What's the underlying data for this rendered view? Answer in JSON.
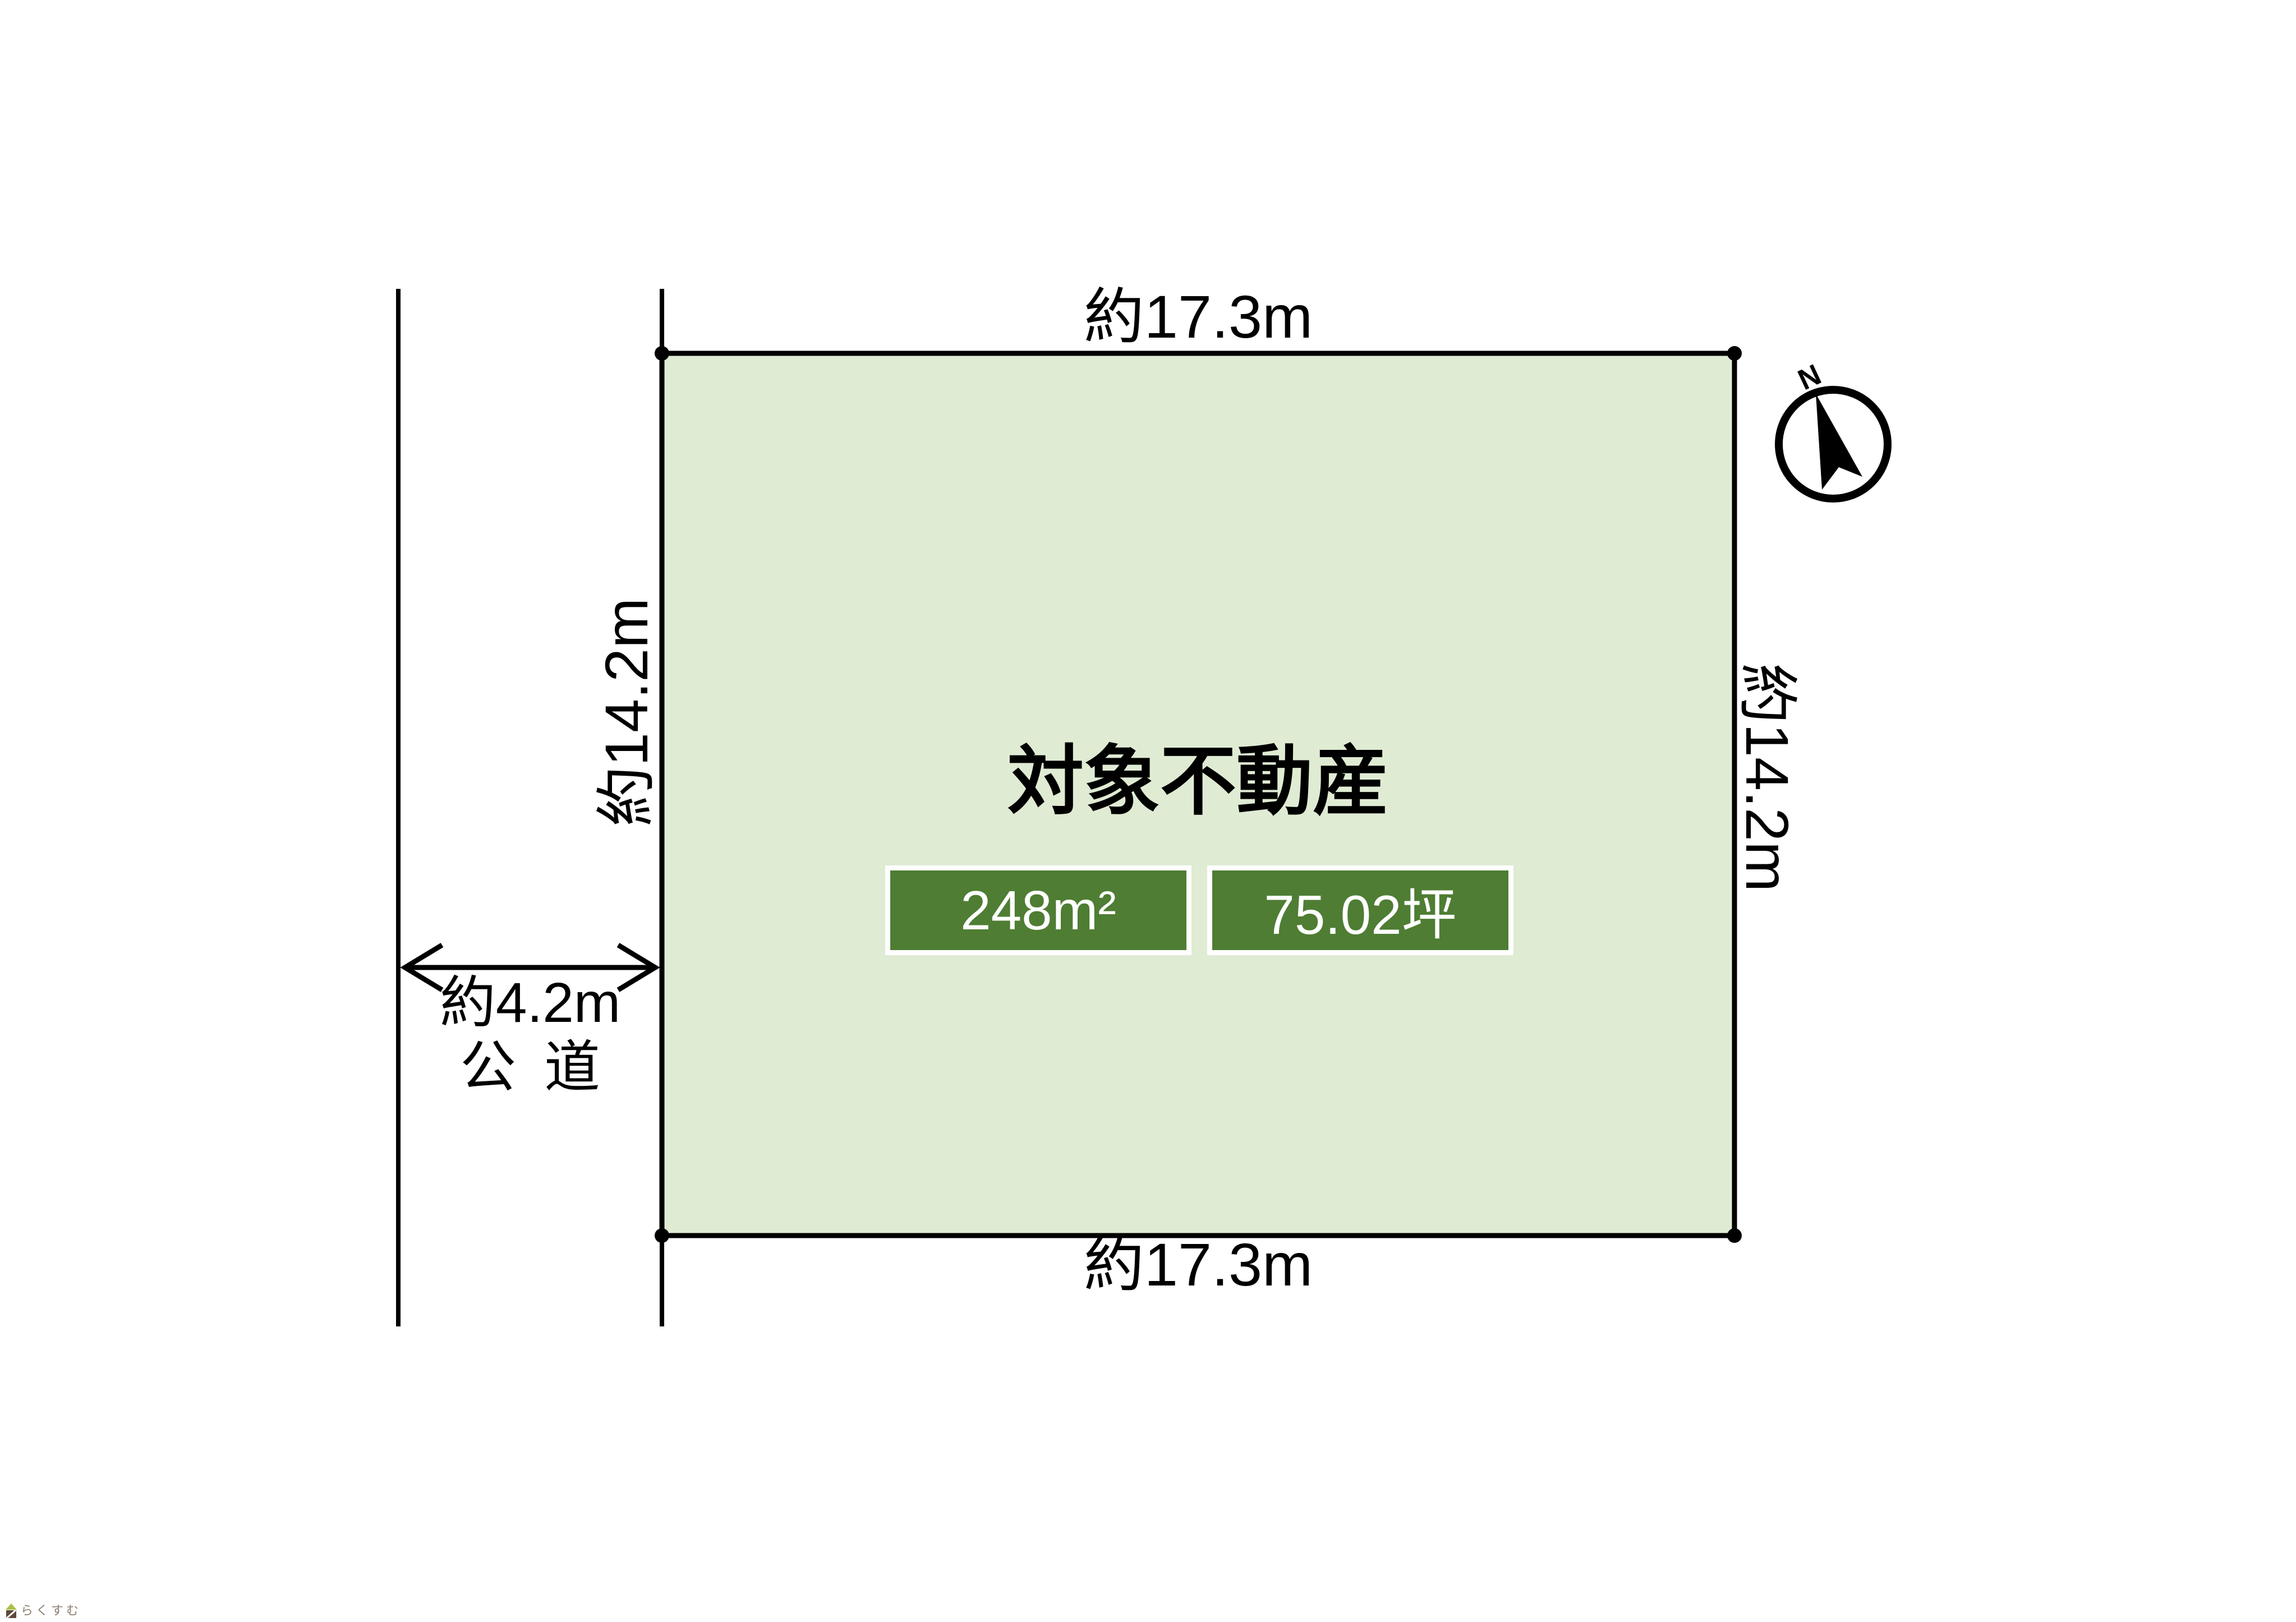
{
  "plot": {
    "title": "対象不動産",
    "area_m2": "248m²",
    "area_tsubo": "75.02坪",
    "top_dimension": "約17.3m",
    "bottom_dimension": "約17.3m",
    "left_dimension": "約14.2m",
    "right_dimension": "約14.2m"
  },
  "road": {
    "width_label": "約4.2m",
    "type_label": "公 道"
  },
  "compass": {
    "north_label": "N"
  },
  "watermark": {
    "logo_text": "らくすむ"
  },
  "colors": {
    "plot_fill": "#dfebd3",
    "plot_border": "#000000",
    "badge_background": "#4e7d33",
    "badge_text": "#ffffff",
    "logo_roof_green": "#a9c24a",
    "logo_house_brown": "#5d4a39",
    "logo_text_brown": "#8b7d6b"
  }
}
